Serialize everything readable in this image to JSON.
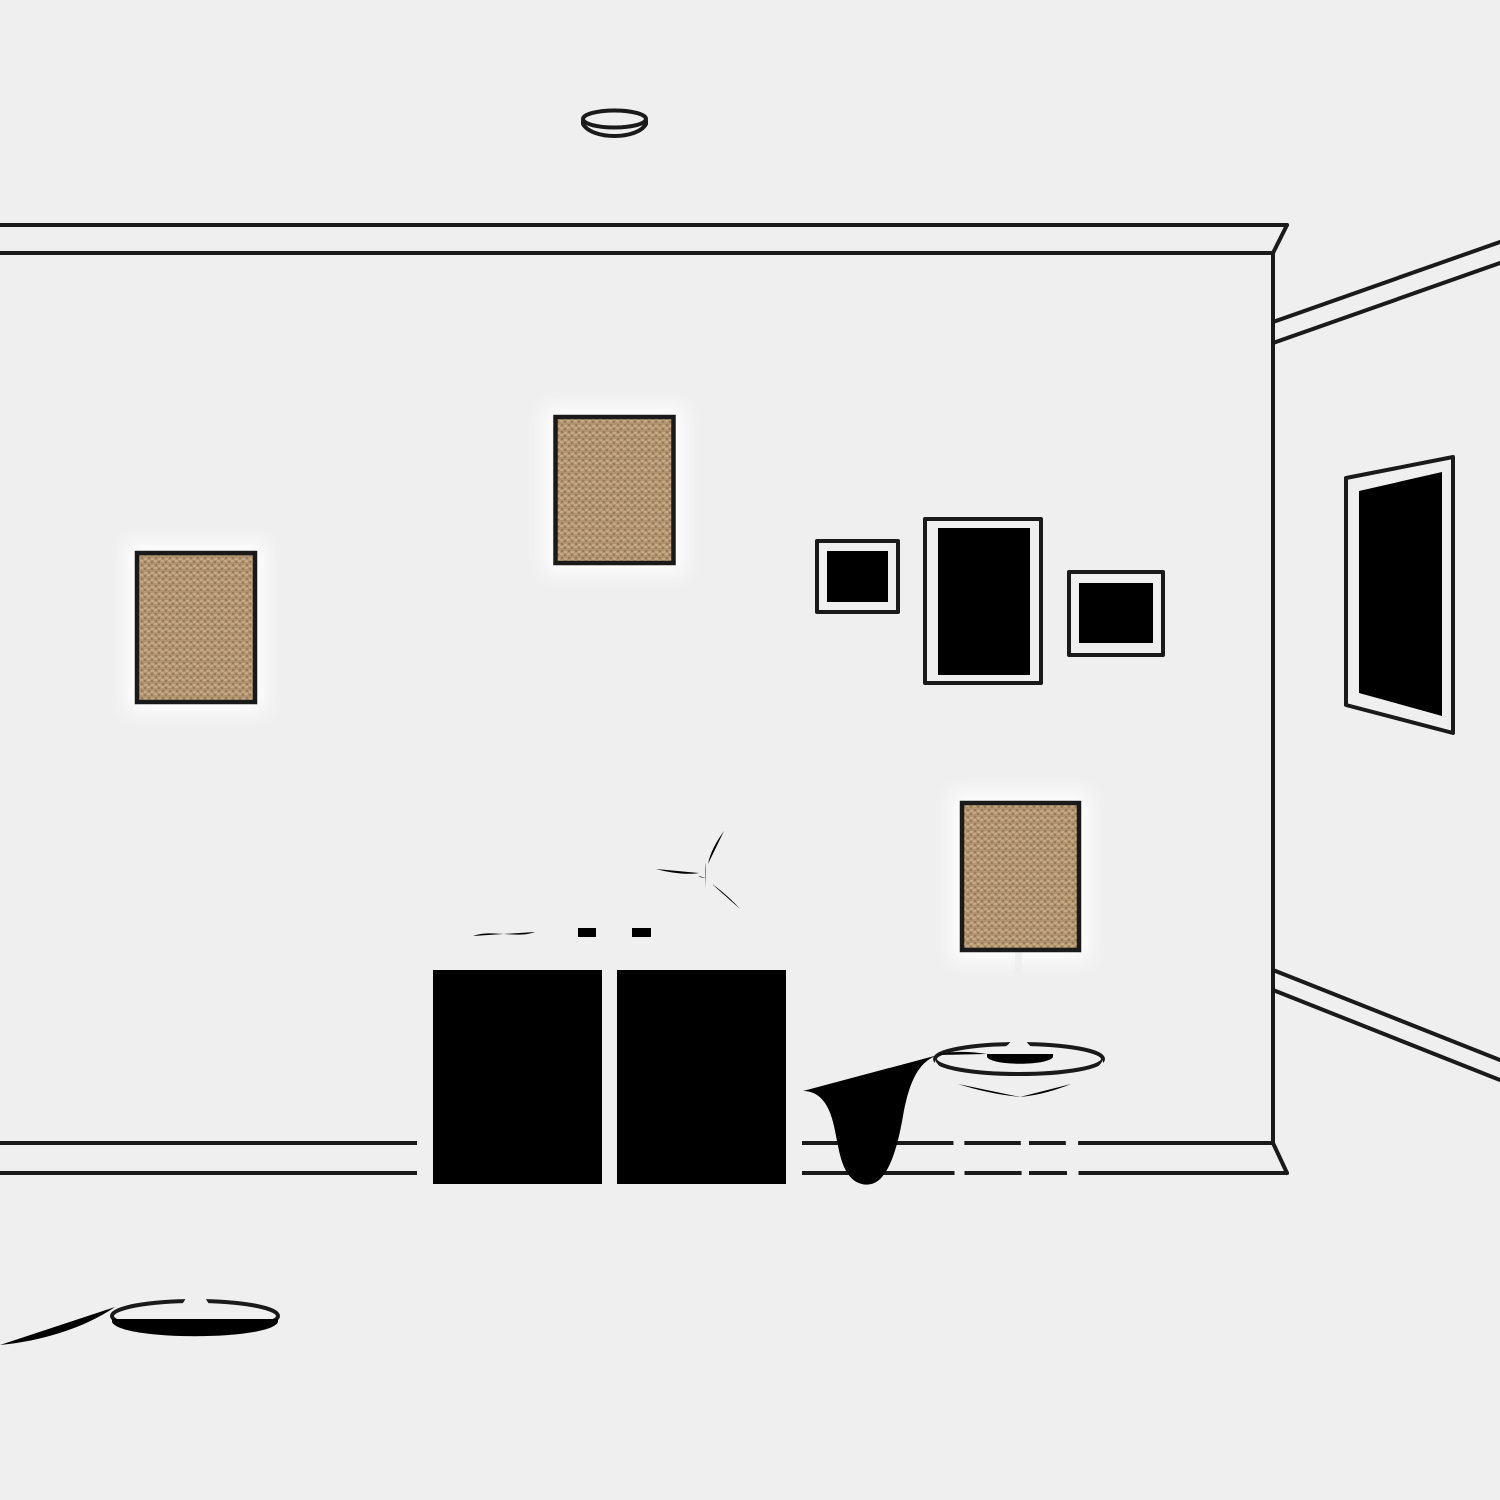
{
  "scene": {
    "label": "Minimal line-art illustration of a living room with three matching tan fabric lamp shades",
    "objects": {
      "pendant_lamp": "pendant lamp hanging from ceiling canopy",
      "floor_lamp": "floor lamp with round disc base and cord",
      "table_lamp": "table lamp standing on round side table",
      "side_table": "round three-legged side table",
      "cabinet": "two-door sideboard cabinet on splayed legs",
      "reed_diffuser": "round reed diffuser with three sticks",
      "radio": "small stacked radio boxes",
      "plant_vase": "vase with three-leaf plant",
      "frame_waves": "small square wall frame with wavy lines",
      "frame_mountain": "tall wall frame with sun and mountains",
      "frame_seascape": "wall frame with sun and wave swirl",
      "wall_mirror": "tall mirror on receding side wall",
      "crown_molding": "ceiling crown molding",
      "baseboard": "wall baseboard",
      "power_cord": "power cord from table lamp to cabinet"
    }
  },
  "colors": {
    "background": "#efefef",
    "line": "#1a1a1a",
    "shade_base": "#b1946f",
    "shade_texture_light": "#c4aa84",
    "shade_texture_dark": "#977c59",
    "glow": "#ffffff"
  }
}
